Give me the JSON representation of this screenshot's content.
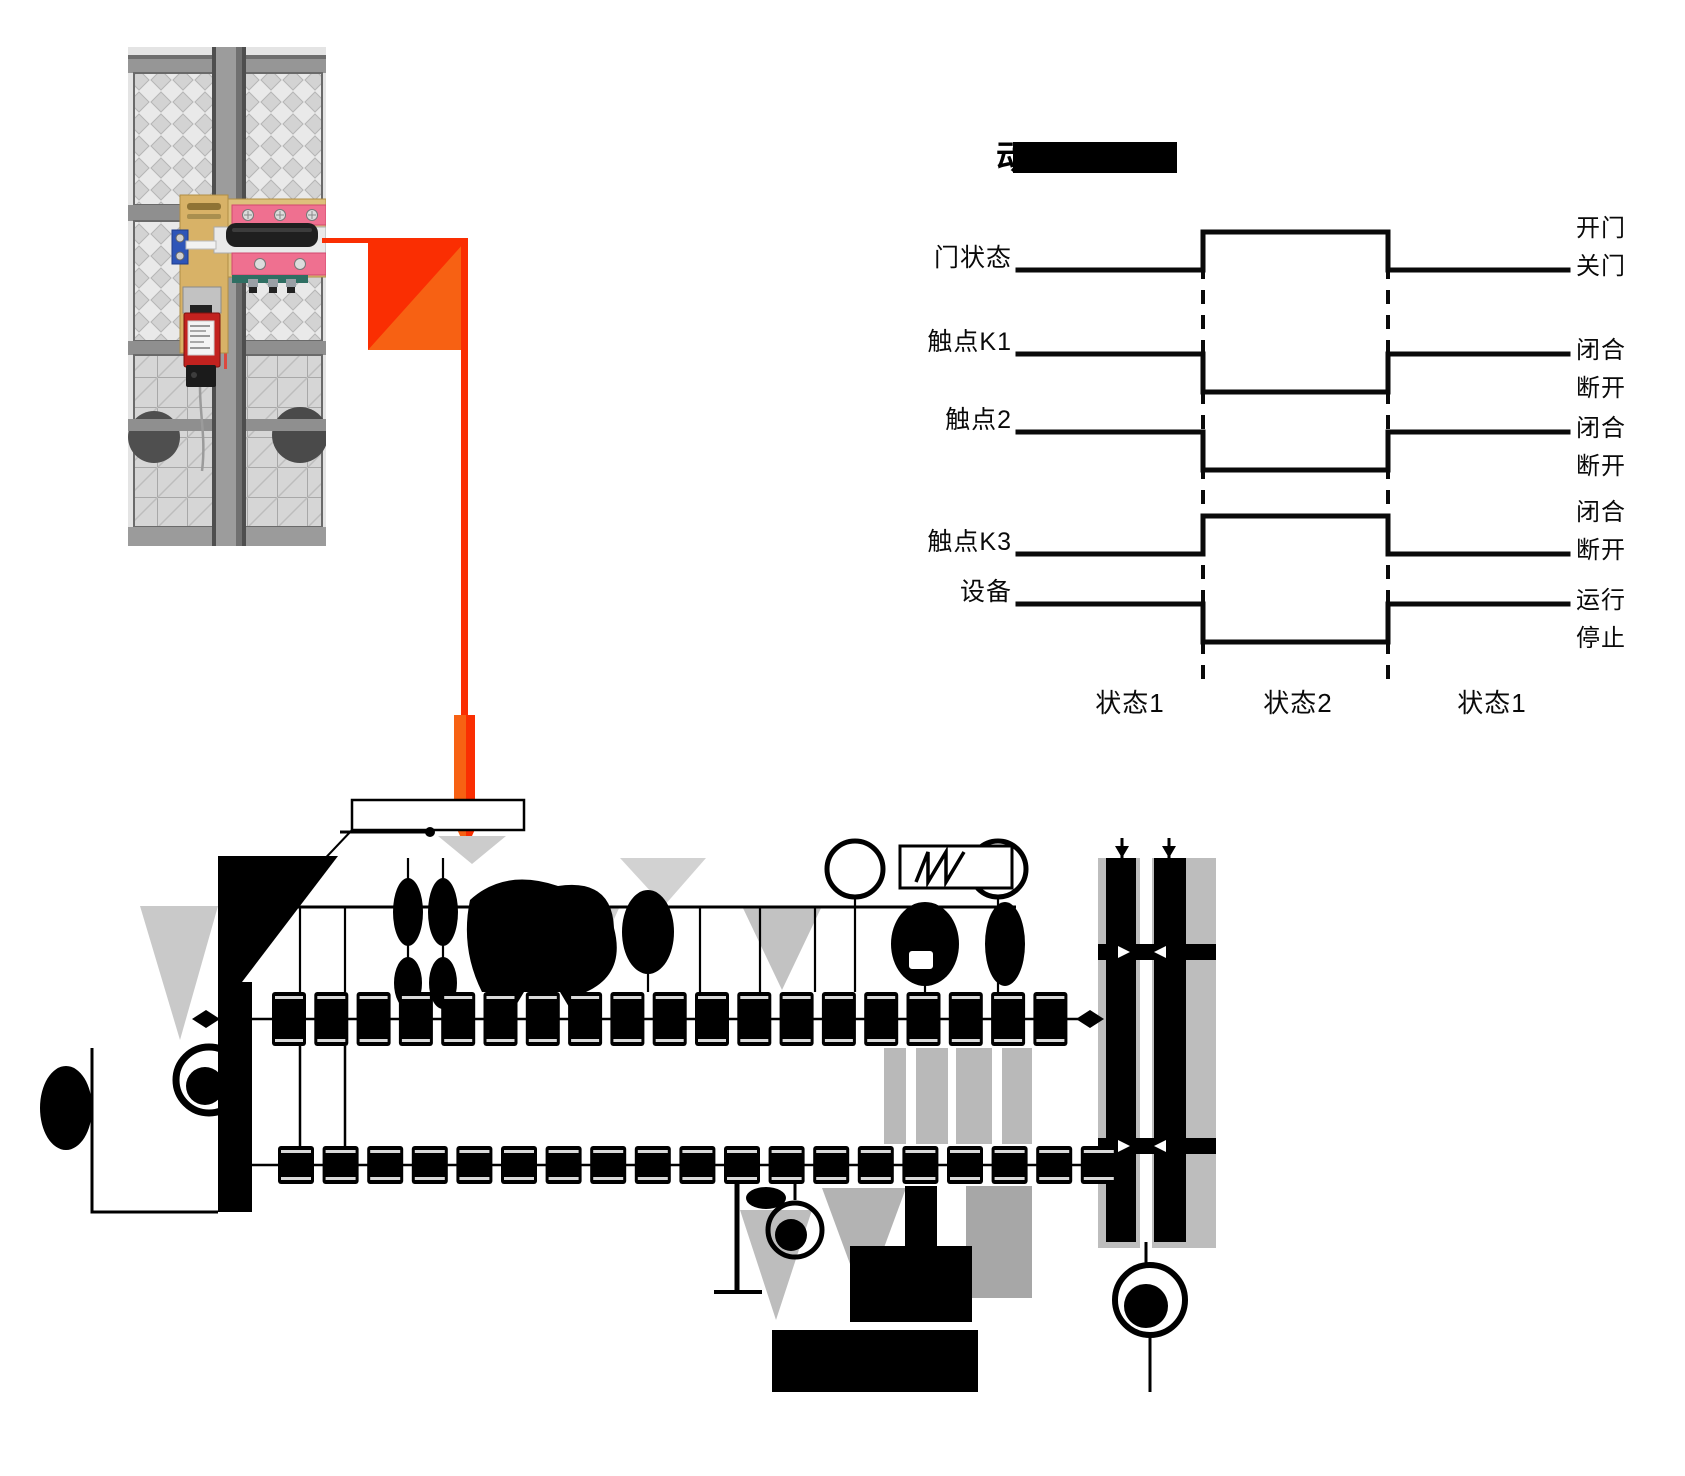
{
  "title": {
    "fragment": "动",
    "redacted": true,
    "bar_color": "#000000"
  },
  "chart_data": {
    "type": "timing",
    "title_visible_fragment": "动",
    "legend_position": "right",
    "line_color": "#0a0a0a",
    "phases": [
      "状态1",
      "状态2",
      "状态1"
    ],
    "signals": [
      {
        "label": "门状态",
        "level_high": "开门",
        "level_low": "关门",
        "states": [
          "low",
          "high",
          "low"
        ]
      },
      {
        "label": "触点K1",
        "level_high": "闭合",
        "level_low": "断开",
        "states": [
          "high",
          "low",
          "high"
        ]
      },
      {
        "label": "触点2",
        "level_high": "闭合",
        "level_low": "断开",
        "states": [
          "high",
          "low",
          "high"
        ]
      },
      {
        "label": "触点K3",
        "level_high": "闭合",
        "level_low": "断开",
        "states": [
          "low",
          "high",
          "low"
        ]
      },
      {
        "label": "设备",
        "level_high": "运行",
        "level_low": "停止",
        "states": [
          "high",
          "low",
          "high"
        ]
      }
    ]
  },
  "callout_arrow": {
    "color_red": "#fa2e02",
    "color_orange": "#f76113",
    "direction": "down"
  },
  "photo_palette": {
    "fence_gray": "#e4e4e4",
    "rail_gray": "#8f8f8f",
    "post_gray": "#9c9c9c",
    "plate_tan": "#d8b267",
    "bracket_pink": "#ef7090",
    "clamp_blue": "#2e55b8",
    "switch_red": "#c2221f",
    "handle_black": "#1f1f1f"
  }
}
